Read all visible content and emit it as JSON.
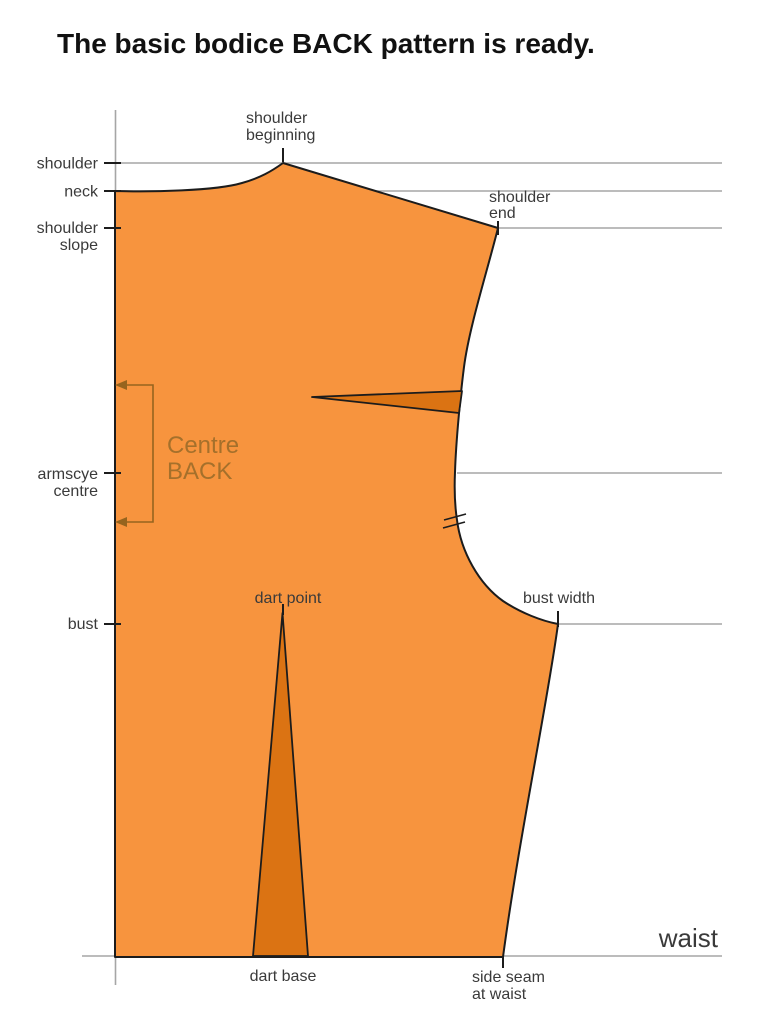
{
  "title": "The basic bodice BACK pattern is ready.",
  "diagram": {
    "left_labels": {
      "shoulder": "shoulder",
      "neck": "neck",
      "shoulder_slope": [
        "shoulder",
        "slope"
      ],
      "armscye_centre": [
        "armscye",
        "centre"
      ],
      "bust": "bust"
    },
    "point_labels": {
      "shoulder_beginning": [
        "shoulder",
        "beginning"
      ],
      "shoulder_end": [
        "shoulder",
        "end"
      ],
      "dart_point": "dart point",
      "bust_width": "bust width",
      "dart_base": "dart base",
      "side_seam_at_waist": [
        "side seam",
        "at waist"
      ],
      "waist": "waist"
    },
    "pattern_text": [
      "Centre",
      "BACK"
    ]
  },
  "colors": {
    "pattern_fill": "#F7943E",
    "dart_fill": "#DB7313",
    "outline": "#1C1C1C",
    "guide_line": "#A6A6A6",
    "label_text": "#3A3A3A",
    "title_text": "#111111",
    "centre_back_text": "#A5702B",
    "bracket": "#96641E"
  }
}
